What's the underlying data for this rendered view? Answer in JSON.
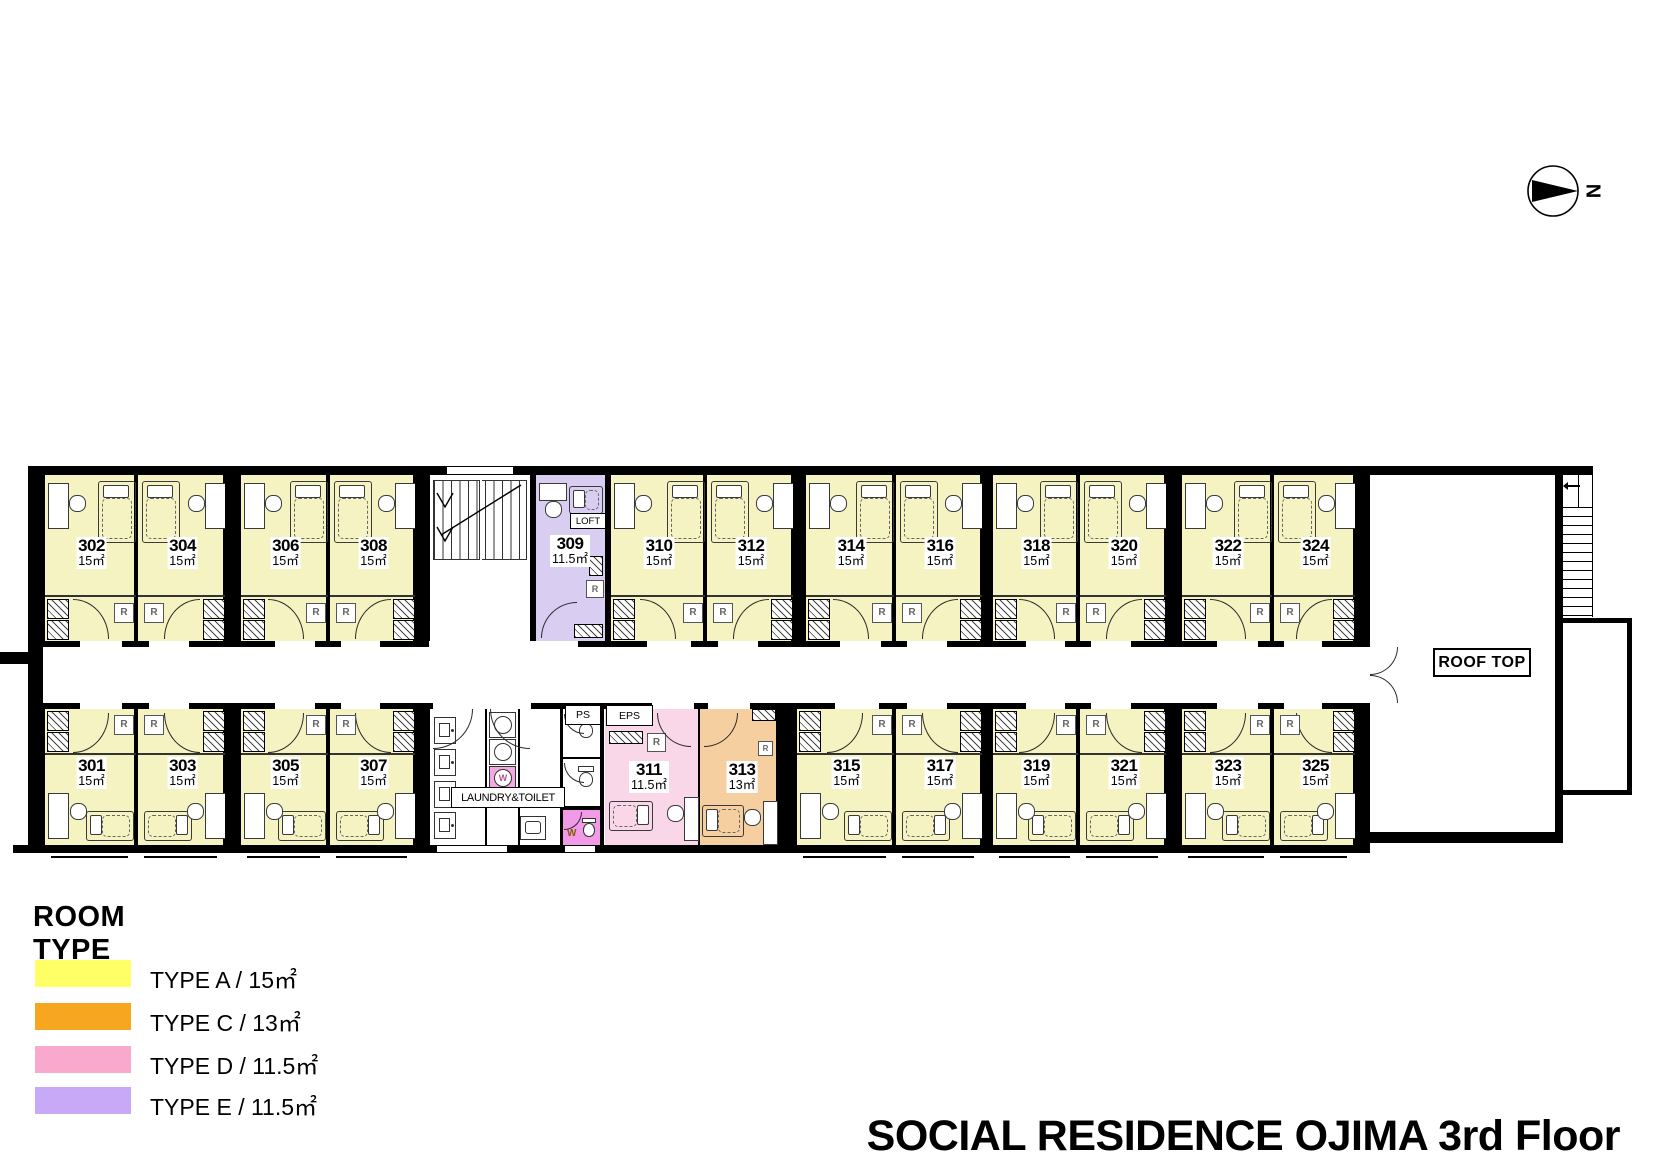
{
  "title": "SOCIAL RESIDENCE OJIMA  3rd Floor",
  "compass_label": "N",
  "legend": {
    "heading": "ROOM TYPE",
    "items": [
      {
        "type": "A",
        "label": "TYPE A / 15㎡",
        "color": "#FFFF66"
      },
      {
        "type": "C",
        "label": "TYPE C / 13㎡",
        "color": "#F7A620"
      },
      {
        "type": "D",
        "label": "TYPE D / 11.5㎡",
        "color": "#F9A8CE"
      },
      {
        "type": "E",
        "label": "TYPE E / 11.5㎡",
        "color": "#C8A9F7"
      }
    ]
  },
  "areas": {
    "roof_top": "ROOF TOP",
    "laundry": "LAUNDRY&TOILET",
    "loft": "LOFT",
    "ps": "PS",
    "eps": "EPS",
    "fridge": "R",
    "washer": "W"
  },
  "room_fill_colors": {
    "A": "#F5F3C2",
    "C": "#F6CFA1",
    "D": "#F9D7E8",
    "E": "#D9CDF2"
  },
  "accent_colors": {
    "ink": "#000000",
    "washer_room": "#F09AE8",
    "washer_box": "#F4A9E2"
  },
  "rooms": {
    "top": [
      {
        "number": "302",
        "area": "15㎡",
        "type": "A"
      },
      {
        "number": "304",
        "area": "15㎡",
        "type": "A"
      },
      {
        "number": "306",
        "area": "15㎡",
        "type": "A"
      },
      {
        "number": "308",
        "area": "15㎡",
        "type": "A"
      },
      {
        "number": "309",
        "area": "11.5㎡",
        "type": "E"
      },
      {
        "number": "310",
        "area": "15㎡",
        "type": "A"
      },
      {
        "number": "312",
        "area": "15㎡",
        "type": "A"
      },
      {
        "number": "314",
        "area": "15㎡",
        "type": "A"
      },
      {
        "number": "316",
        "area": "15㎡",
        "type": "A"
      },
      {
        "number": "318",
        "area": "15㎡",
        "type": "A"
      },
      {
        "number": "320",
        "area": "15㎡",
        "type": "A"
      },
      {
        "number": "322",
        "area": "15㎡",
        "type": "A"
      },
      {
        "number": "324",
        "area": "15㎡",
        "type": "A"
      }
    ],
    "bottom": [
      {
        "number": "301",
        "area": "15㎡",
        "type": "A"
      },
      {
        "number": "303",
        "area": "15㎡",
        "type": "A"
      },
      {
        "number": "305",
        "area": "15㎡",
        "type": "A"
      },
      {
        "number": "307",
        "area": "15㎡",
        "type": "A"
      },
      {
        "number": "311",
        "area": "11.5㎡",
        "type": "D"
      },
      {
        "number": "313",
        "area": "13㎡",
        "type": "C"
      },
      {
        "number": "315",
        "area": "15㎡",
        "type": "A"
      },
      {
        "number": "317",
        "area": "15㎡",
        "type": "A"
      },
      {
        "number": "319",
        "area": "15㎡",
        "type": "A"
      },
      {
        "number": "321",
        "area": "15㎡",
        "type": "A"
      },
      {
        "number": "323",
        "area": "15㎡",
        "type": "A"
      },
      {
        "number": "325",
        "area": "15㎡",
        "type": "A"
      }
    ]
  }
}
